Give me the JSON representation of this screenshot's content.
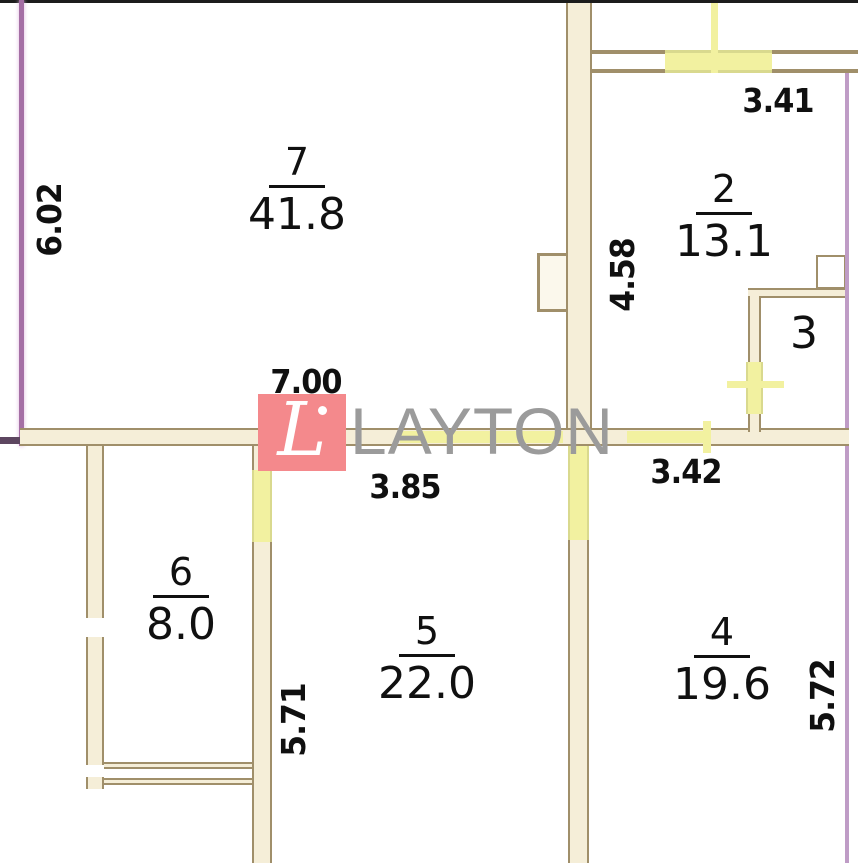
{
  "watermark": {
    "logo_letter": "L",
    "brand": "LAYTON"
  },
  "rooms": [
    {
      "number": "7",
      "area": "41.8"
    },
    {
      "number": "2",
      "area": "13.1"
    },
    {
      "number": "3"
    },
    {
      "number": "6",
      "area": "8.0"
    },
    {
      "number": "5",
      "area": "22.0"
    },
    {
      "number": "4",
      "area": "19.6"
    }
  ],
  "dimensions": {
    "left_height": "6.02",
    "balcony_window_width": "3.41",
    "room2_height": "4.58",
    "room7_width": "7.00",
    "room5_width": "3.85",
    "room4_width": "3.42",
    "room5_height": "5.71",
    "room4_height": "5.72"
  },
  "colors": {
    "wall_line": "#a08f6a",
    "wall_fill": "#f5eed8",
    "window_yellow": "#f2f1a0",
    "window_edge": "#d9d98e",
    "outer_wall_left": "#a56fa5",
    "outer_wall_right": "#bf9cc6",
    "logo_red": "#f4898c",
    "brand_gray": "#9b9b9b"
  }
}
